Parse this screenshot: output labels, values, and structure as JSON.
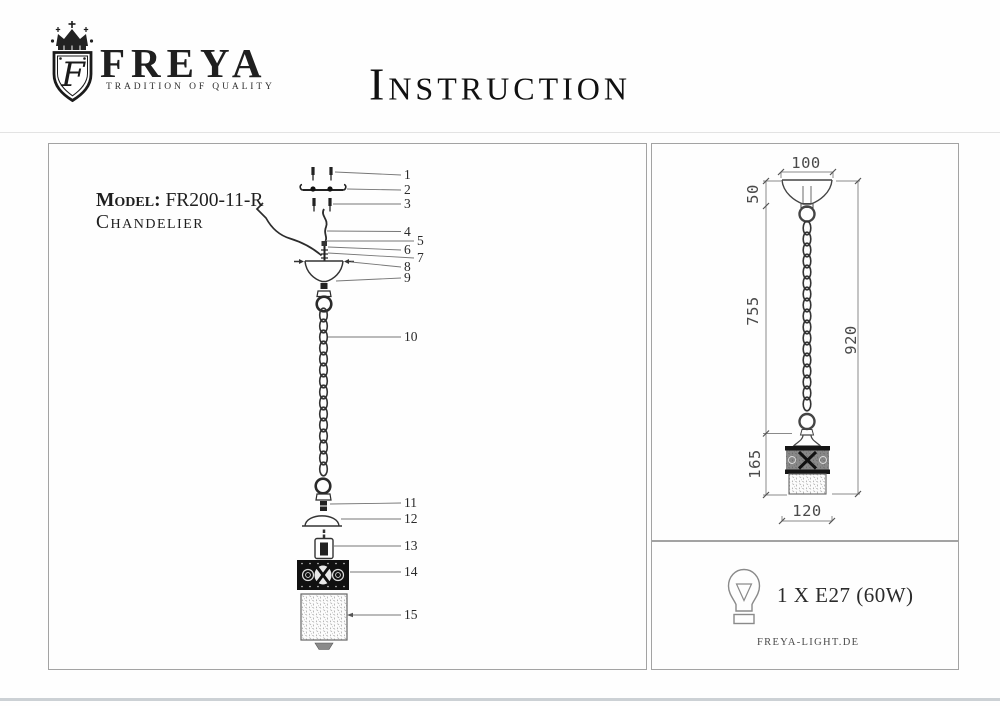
{
  "header": {
    "logo": {
      "brand": "FREYA",
      "tagline": "TRADITION OF QUALITY",
      "monogram": "F",
      "crest_icon": "crowned-shield"
    },
    "title": "Instruction"
  },
  "left_panel": {
    "model_label": "Model:",
    "model_value": "FR200-11-R",
    "product_type": "Chandelier",
    "callouts": [
      "1",
      "2",
      "3",
      "4",
      "5",
      "6",
      "7",
      "8",
      "9",
      "10",
      "11",
      "12",
      "13",
      "14",
      "15"
    ]
  },
  "right_panel": {
    "dimensions": {
      "canopy_width": "100",
      "canopy_height": "50",
      "suspension_length": "755",
      "overall_height": "920",
      "shade_height": "165",
      "shade_width": "120"
    }
  },
  "spec_panel": {
    "bulb_icon": "light-bulb-outline",
    "lamp_spec": "1 X E27 (60W)",
    "website": "FREYA-LIGHT.DE"
  },
  "colors": {
    "ink": "#1f1f1f",
    "drawing_line": "#3f3f3f",
    "dimension_line": "#8a8a8a",
    "panel_border": "#a3a3a3"
  }
}
